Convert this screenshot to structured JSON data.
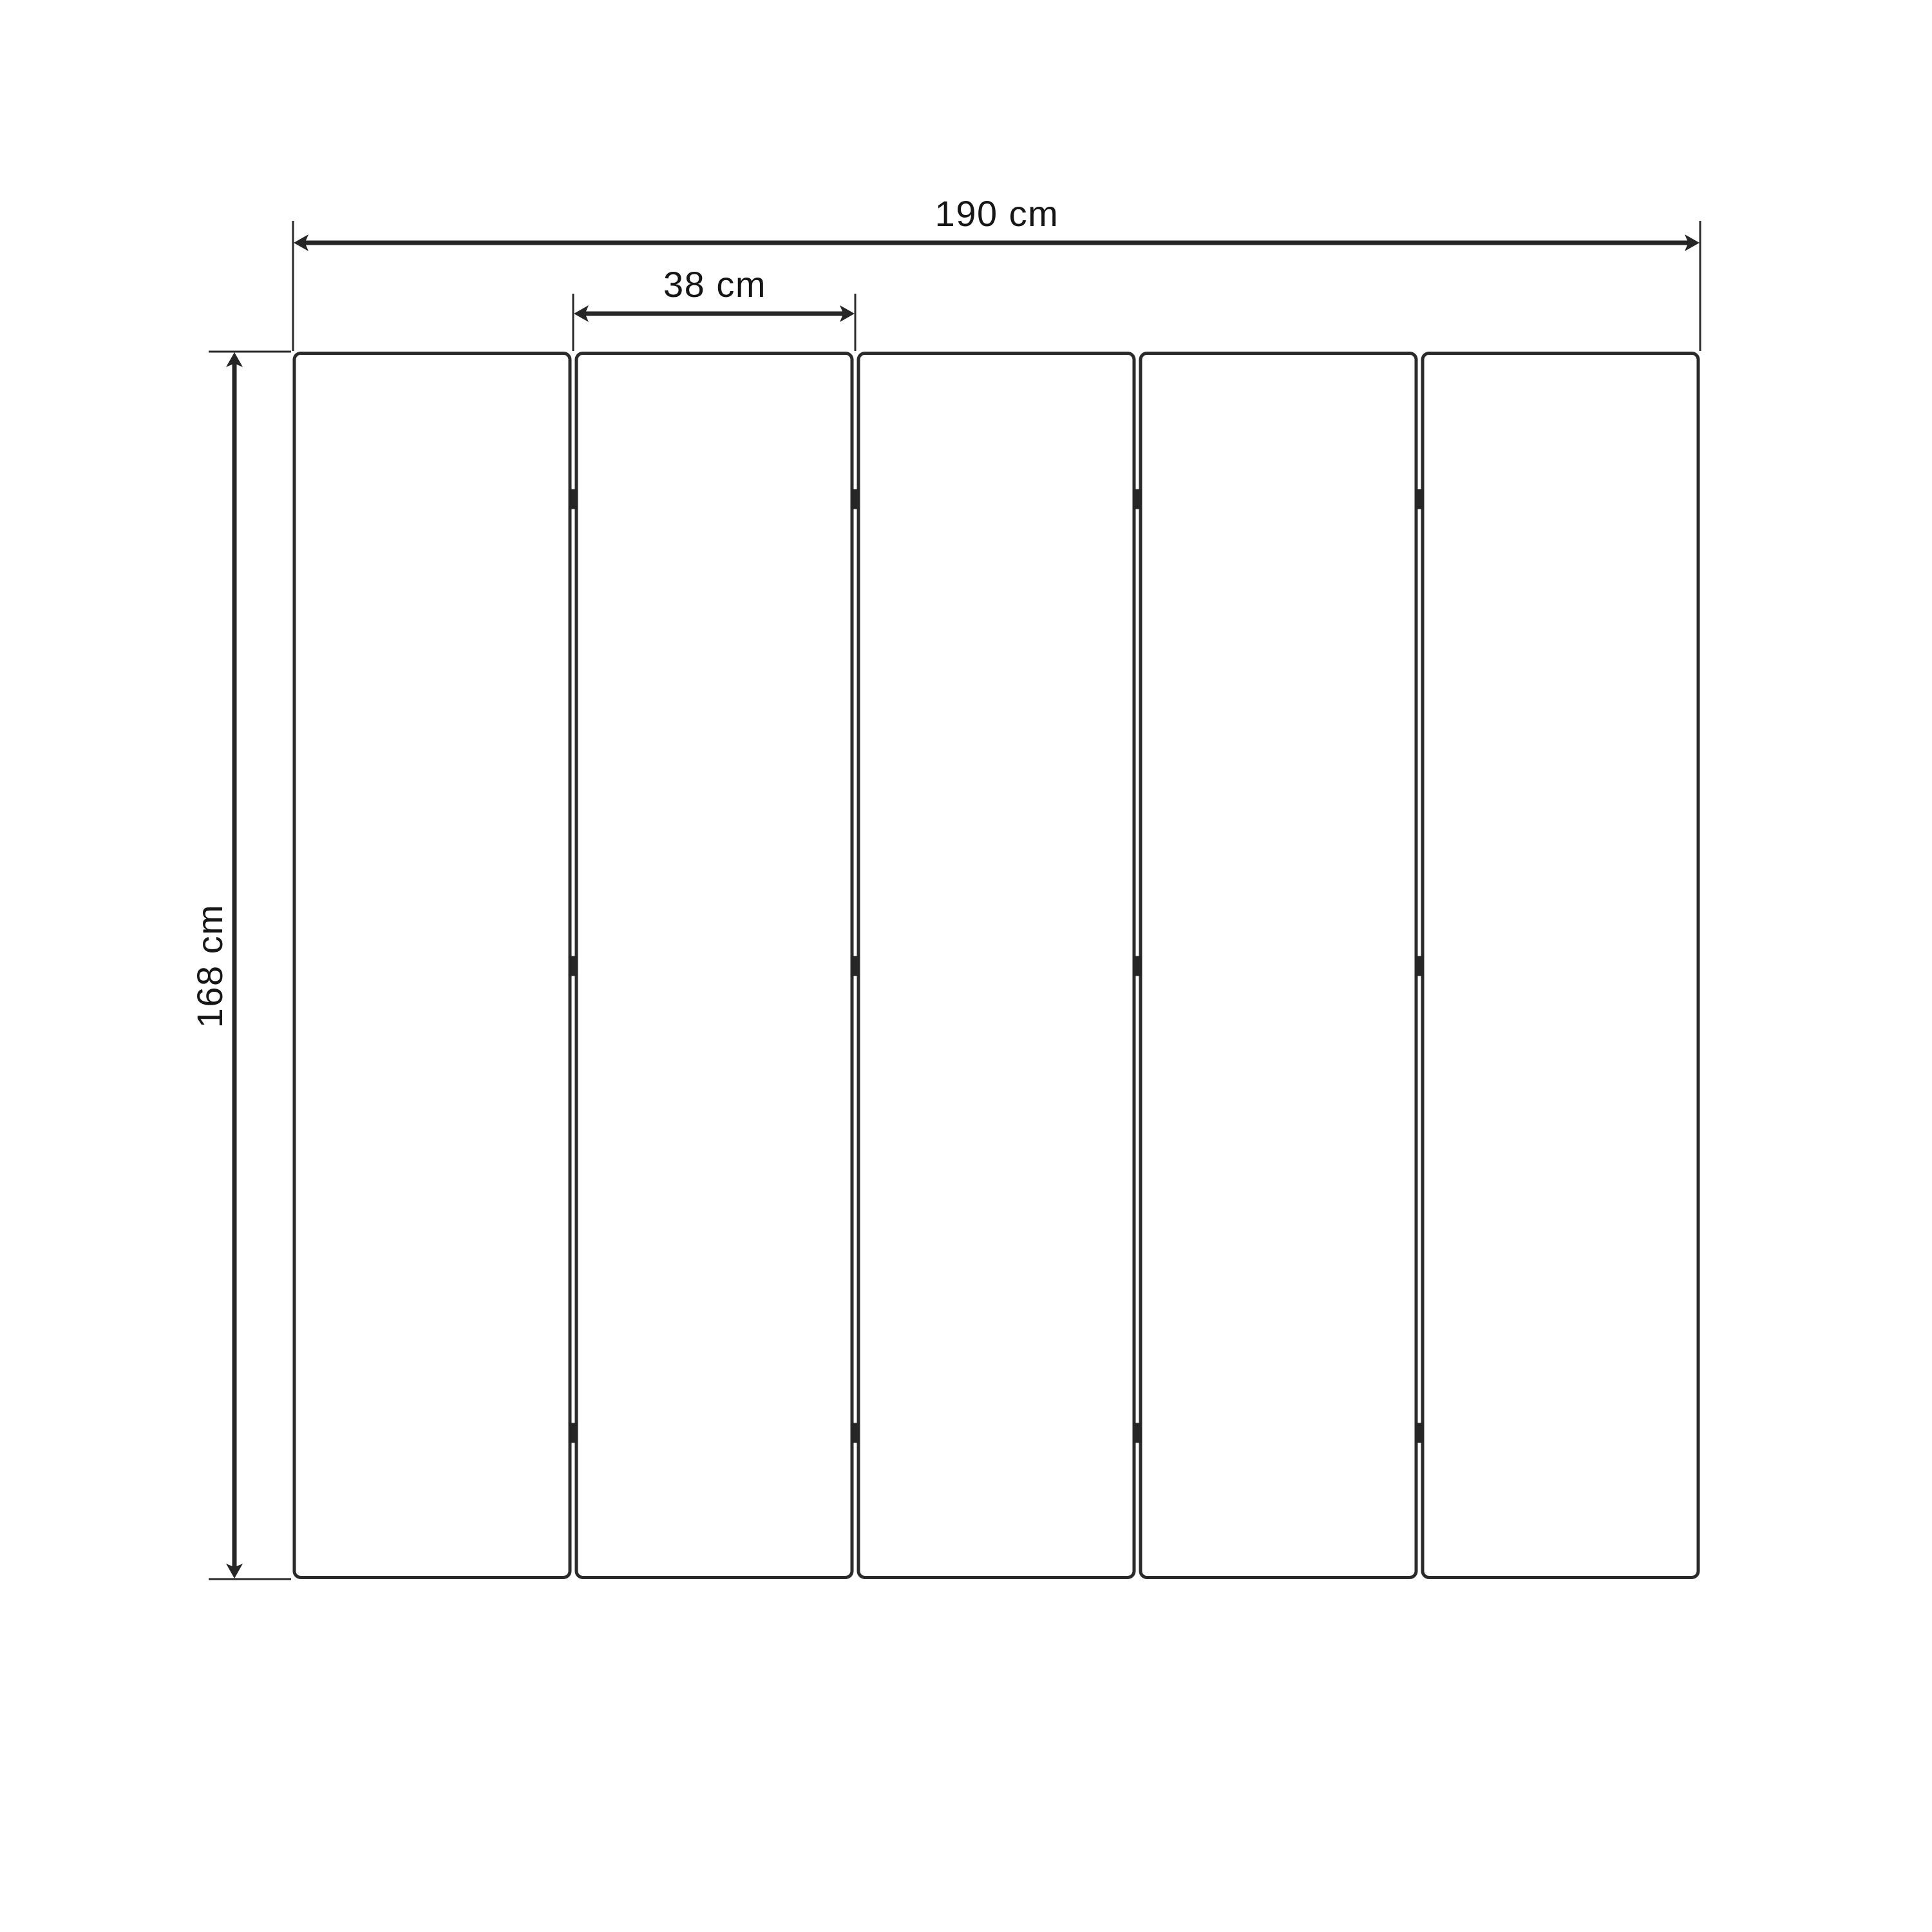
{
  "diagram": {
    "type": "technical-dimension-drawing",
    "subject": "Five-panel folding screen / room divider, front elevation",
    "background_color": "#ffffff",
    "line_color": "#262626",
    "text_color": "#161616",
    "panels": {
      "count": 5,
      "hinge_marks_per_gap": 3
    },
    "dimensions": {
      "total_width": {
        "label": "190 cm",
        "value": 190,
        "unit": "cm",
        "orientation": "horizontal"
      },
      "panel_width": {
        "label": "38 cm",
        "value": 38,
        "unit": "cm",
        "orientation": "horizontal"
      },
      "height": {
        "label": "168 cm",
        "value": 168,
        "unit": "cm",
        "orientation": "vertical"
      }
    }
  }
}
